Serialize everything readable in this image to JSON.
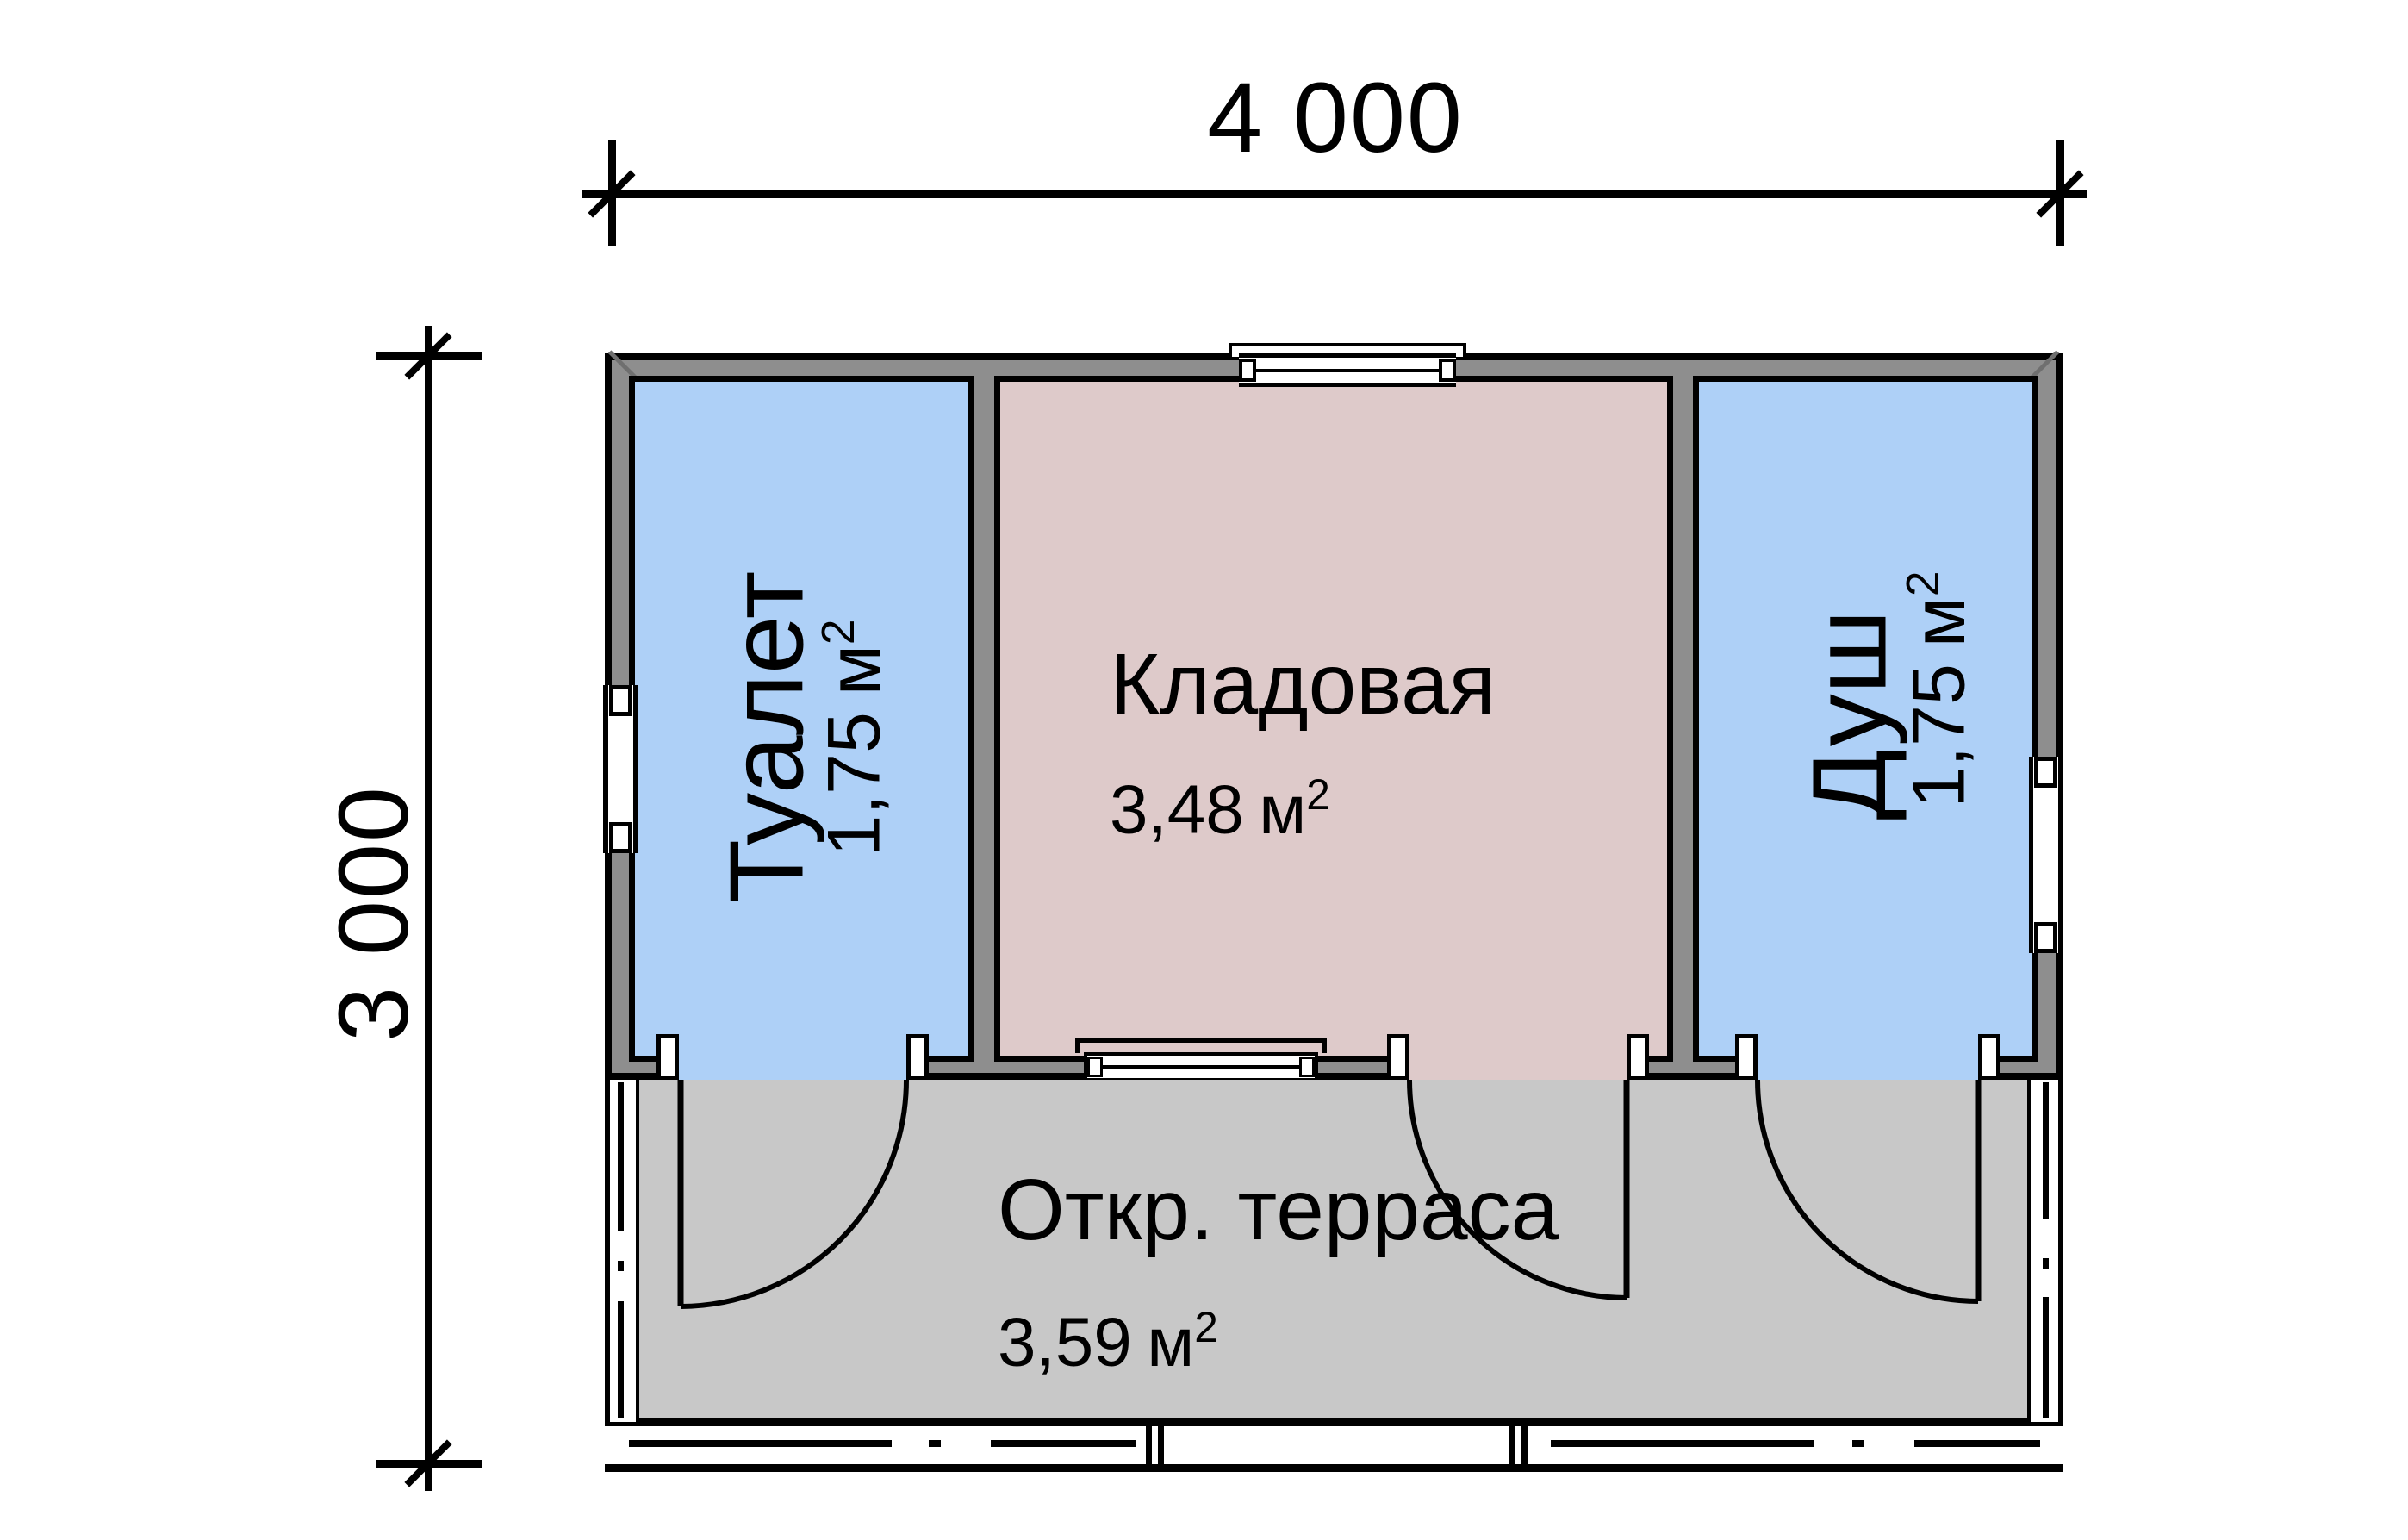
{
  "drawing": {
    "type": "floor-plan",
    "dimension_top": "4 000",
    "dimension_left": "3 000"
  },
  "rooms": {
    "toilet": {
      "name": "Туалет",
      "area": "1,75",
      "unit": "м",
      "unit_sup": "2"
    },
    "storage": {
      "name": "Кладовая",
      "area": "3,48",
      "unit": "м",
      "unit_sup": "2"
    },
    "shower": {
      "name": "Душ",
      "area": "1,75",
      "unit": "м",
      "unit_sup": "2"
    },
    "terrace": {
      "name": "Откр. терраса",
      "area": "3,59",
      "unit": "м",
      "unit_sup": "2"
    }
  },
  "colors": {
    "wet_room_fill": "#aed0f7",
    "storage_fill": "#decaca",
    "wall_fill": "#8e8e8e",
    "terrace_fill": "#c8c8c8",
    "line": "#000000",
    "background": "#ffffff"
  }
}
